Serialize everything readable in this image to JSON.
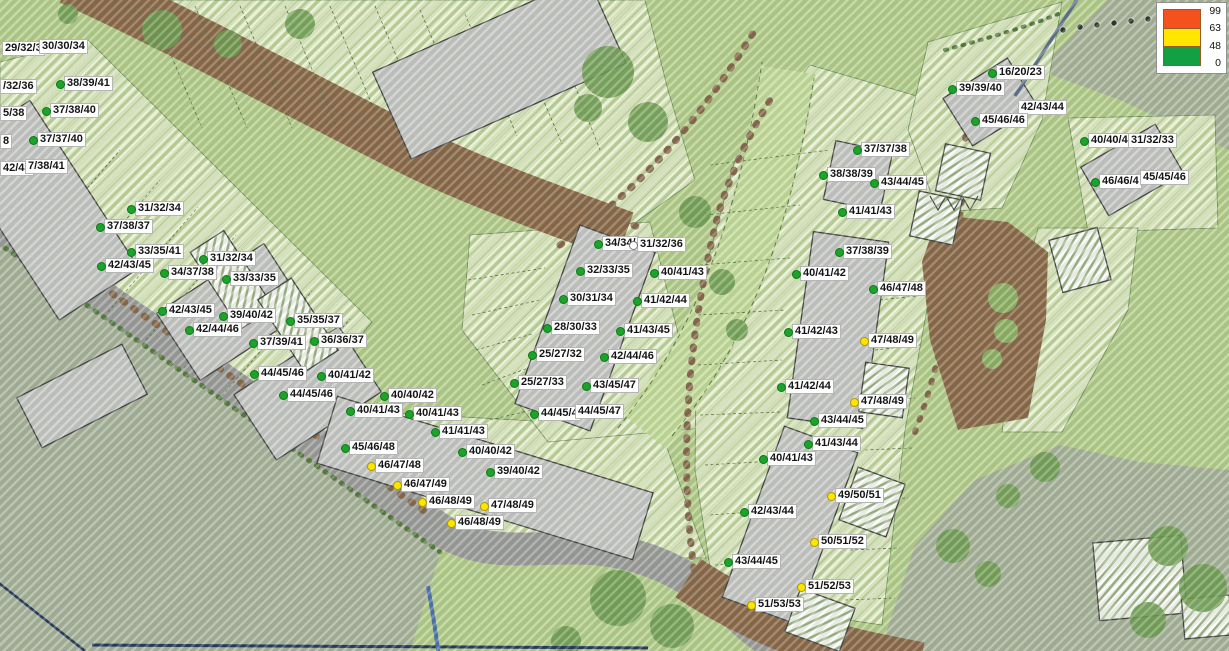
{
  "legend": {
    "values": [
      "99",
      "63",
      "48",
      "0"
    ],
    "bands": [
      {
        "color": "#f4511e"
      },
      {
        "color": "#ffe500"
      },
      {
        "color": "#12a042"
      }
    ]
  },
  "palette": {
    "marker_green": "#1ca32b",
    "marker_yellow": "#ffe400",
    "plot_hatch_green": "#c2d6a0",
    "road_gray": "#9c9c9c",
    "road_dirt_brown": "#8a6848",
    "building_gray": "#c8c8c8"
  },
  "receivers": [
    {
      "x": 2,
      "y": 38,
      "text": "29/32/3",
      "marker": "none"
    },
    {
      "x": 39,
      "y": 36,
      "text": "30/30/34",
      "marker": "none"
    },
    {
      "x": 0,
      "y": 76,
      "text": "/32/36",
      "marker": "none"
    },
    {
      "x": 0,
      "y": 103,
      "text": "5/38",
      "marker": "none"
    },
    {
      "x": 0,
      "y": 131,
      "text": "8",
      "marker": "none"
    },
    {
      "x": 0,
      "y": 158,
      "text": "42/43",
      "marker": "none"
    },
    {
      "x": 25,
      "y": 156,
      "text": "7/38/41",
      "marker": "none"
    },
    {
      "x": 64,
      "y": 73,
      "text": "38/39/41",
      "marker": "green"
    },
    {
      "x": 50,
      "y": 100,
      "text": "37/38/40",
      "marker": "green"
    },
    {
      "x": 37,
      "y": 129,
      "text": "37/37/40",
      "marker": "green"
    },
    {
      "x": 135,
      "y": 198,
      "text": "31/32/34",
      "marker": "green"
    },
    {
      "x": 104,
      "y": 216,
      "text": "37/38/37",
      "marker": "green"
    },
    {
      "x": 135,
      "y": 241,
      "text": "33/35/41",
      "marker": "green"
    },
    {
      "x": 105,
      "y": 255,
      "text": "42/43/45",
      "marker": "green"
    },
    {
      "x": 207,
      "y": 248,
      "text": "31/32/34",
      "marker": "green"
    },
    {
      "x": 168,
      "y": 262,
      "text": "34/37/38",
      "marker": "green"
    },
    {
      "x": 230,
      "y": 268,
      "text": "33/33/35",
      "marker": "green"
    },
    {
      "x": 166,
      "y": 300,
      "text": "42/43/45",
      "marker": "green"
    },
    {
      "x": 227,
      "y": 305,
      "text": "39/40/42",
      "marker": "green"
    },
    {
      "x": 193,
      "y": 319,
      "text": "42/44/46",
      "marker": "green"
    },
    {
      "x": 294,
      "y": 310,
      "text": "35/35/37",
      "marker": "green"
    },
    {
      "x": 257,
      "y": 332,
      "text": "37/39/41",
      "marker": "green"
    },
    {
      "x": 318,
      "y": 330,
      "text": "36/36/37",
      "marker": "green"
    },
    {
      "x": 258,
      "y": 363,
      "text": "44/45/46",
      "marker": "green"
    },
    {
      "x": 325,
      "y": 365,
      "text": "40/41/42",
      "marker": "green"
    },
    {
      "x": 287,
      "y": 384,
      "text": "44/45/46",
      "marker": "green"
    },
    {
      "x": 388,
      "y": 385,
      "text": "40/40/42",
      "marker": "green"
    },
    {
      "x": 354,
      "y": 400,
      "text": "40/41/43",
      "marker": "green"
    },
    {
      "x": 413,
      "y": 403,
      "text": "40/41/43",
      "marker": "green"
    },
    {
      "x": 439,
      "y": 421,
      "text": "41/41/43",
      "marker": "green"
    },
    {
      "x": 349,
      "y": 437,
      "text": "45/46/48",
      "marker": "green"
    },
    {
      "x": 466,
      "y": 441,
      "text": "40/40/42",
      "marker": "green"
    },
    {
      "x": 375,
      "y": 455,
      "text": "46/47/48",
      "marker": "yellow"
    },
    {
      "x": 494,
      "y": 461,
      "text": "39/40/42",
      "marker": "green"
    },
    {
      "x": 401,
      "y": 474,
      "text": "46/47/49",
      "marker": "yellow"
    },
    {
      "x": 426,
      "y": 491,
      "text": "46/48/49",
      "marker": "yellow"
    },
    {
      "x": 488,
      "y": 495,
      "text": "47/48/49",
      "marker": "yellow"
    },
    {
      "x": 455,
      "y": 512,
      "text": "46/48/49",
      "marker": "yellow"
    },
    {
      "x": 602,
      "y": 233,
      "text": "34/34/",
      "marker": "green"
    },
    {
      "x": 637,
      "y": 234,
      "text": "31/32/36",
      "marker": "white"
    },
    {
      "x": 584,
      "y": 260,
      "text": "32/33/35",
      "marker": "green"
    },
    {
      "x": 658,
      "y": 262,
      "text": "40/41/43",
      "marker": "green"
    },
    {
      "x": 567,
      "y": 288,
      "text": "30/31/34",
      "marker": "green"
    },
    {
      "x": 641,
      "y": 290,
      "text": "41/42/44",
      "marker": "green"
    },
    {
      "x": 551,
      "y": 317,
      "text": "28/30/33",
      "marker": "green"
    },
    {
      "x": 624,
      "y": 320,
      "text": "41/43/45",
      "marker": "green"
    },
    {
      "x": 536,
      "y": 344,
      "text": "25/27/32",
      "marker": "green"
    },
    {
      "x": 608,
      "y": 346,
      "text": "42/44/46",
      "marker": "green"
    },
    {
      "x": 518,
      "y": 372,
      "text": "25/27/33",
      "marker": "green"
    },
    {
      "x": 590,
      "y": 375,
      "text": "43/45/47",
      "marker": "green"
    },
    {
      "x": 538,
      "y": 403,
      "text": "44/45/4",
      "marker": "green"
    },
    {
      "x": 575,
      "y": 401,
      "text": "44/45/47",
      "marker": "none"
    },
    {
      "x": 861,
      "y": 139,
      "text": "37/37/38",
      "marker": "green"
    },
    {
      "x": 827,
      "y": 164,
      "text": "38/38/39",
      "marker": "green"
    },
    {
      "x": 878,
      "y": 172,
      "text": "43/44/45",
      "marker": "green"
    },
    {
      "x": 846,
      "y": 201,
      "text": "41/41/43",
      "marker": "green"
    },
    {
      "x": 843,
      "y": 241,
      "text": "37/38/39",
      "marker": "green"
    },
    {
      "x": 800,
      "y": 263,
      "text": "40/41/42",
      "marker": "green"
    },
    {
      "x": 877,
      "y": 278,
      "text": "46/47/48",
      "marker": "green"
    },
    {
      "x": 996,
      "y": 62,
      "text": "16/20/23",
      "marker": "green"
    },
    {
      "x": 956,
      "y": 78,
      "text": "39/39/40",
      "marker": "green"
    },
    {
      "x": 1018,
      "y": 97,
      "text": "42/43/44",
      "marker": "none"
    },
    {
      "x": 979,
      "y": 110,
      "text": "45/46/46",
      "marker": "green"
    },
    {
      "x": 1088,
      "y": 130,
      "text": "40/40/4",
      "marker": "green"
    },
    {
      "x": 1128,
      "y": 130,
      "text": "31/32/33",
      "marker": "none"
    },
    {
      "x": 1099,
      "y": 171,
      "text": "46/46/4",
      "marker": "green"
    },
    {
      "x": 1140,
      "y": 167,
      "text": "45/45/46",
      "marker": "none"
    },
    {
      "x": 792,
      "y": 321,
      "text": "41/42/43",
      "marker": "green"
    },
    {
      "x": 868,
      "y": 330,
      "text": "47/48/49",
      "marker": "yellow"
    },
    {
      "x": 785,
      "y": 376,
      "text": "41/42/44",
      "marker": "green"
    },
    {
      "x": 858,
      "y": 391,
      "text": "47/48/49",
      "marker": "yellow"
    },
    {
      "x": 818,
      "y": 410,
      "text": "43/44/45",
      "marker": "green"
    },
    {
      "x": 812,
      "y": 433,
      "text": "41/43/44",
      "marker": "green"
    },
    {
      "x": 767,
      "y": 448,
      "text": "40/41/43",
      "marker": "green"
    },
    {
      "x": 835,
      "y": 485,
      "text": "49/50/51",
      "marker": "yellow"
    },
    {
      "x": 748,
      "y": 501,
      "text": "42/43/44",
      "marker": "green"
    },
    {
      "x": 818,
      "y": 531,
      "text": "50/51/52",
      "marker": "yellow"
    },
    {
      "x": 732,
      "y": 551,
      "text": "43/44/45",
      "marker": "green"
    },
    {
      "x": 805,
      "y": 576,
      "text": "51/52/53",
      "marker": "yellow"
    },
    {
      "x": 755,
      "y": 594,
      "text": "51/53/53",
      "marker": "yellow"
    }
  ]
}
